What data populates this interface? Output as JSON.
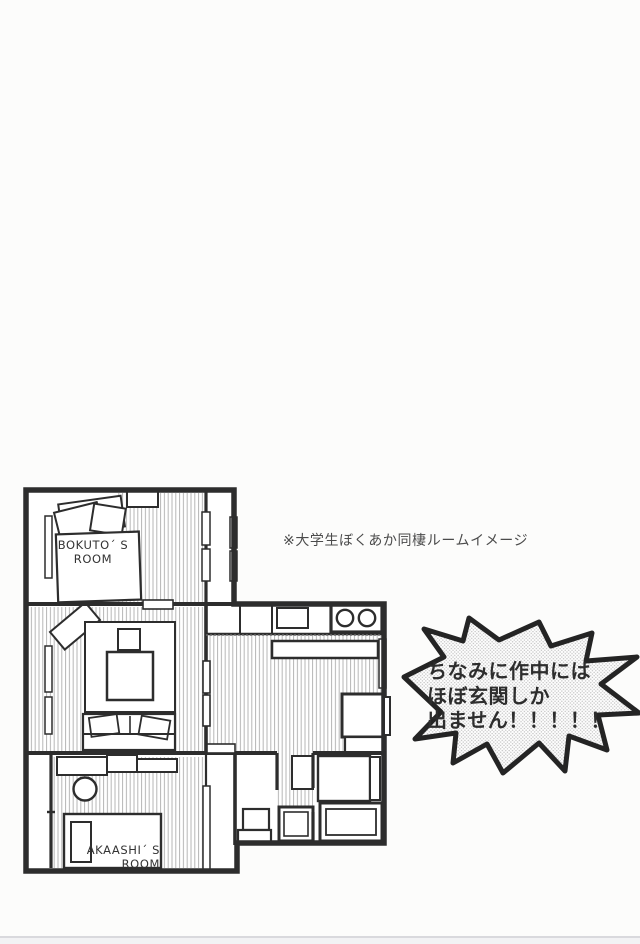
{
  "page": {
    "caption": "※大学生ぼくあか同棲ルームイメージ",
    "speech_bubble": {
      "line1": "ちなみに作中には",
      "line2": "ほぼ玄関しか",
      "line3": "出ません！！！！！"
    },
    "floor_plan": {
      "bokuto_room_label_line1": "BOKUTO´ S",
      "bokuto_room_label_line2": "ROOM",
      "akaashi_room_label_line1": "AKAASHI´ S",
      "akaashi_room_label_line2": "ROOM"
    },
    "colors": {
      "wall": "#2d2d2d",
      "hatch_line": "#b5b5b5",
      "text": "#3c3c3c",
      "bubble_outline": "#242424",
      "screentone_dot": "#c4c4c4",
      "paper": "#fcfcfb"
    }
  }
}
